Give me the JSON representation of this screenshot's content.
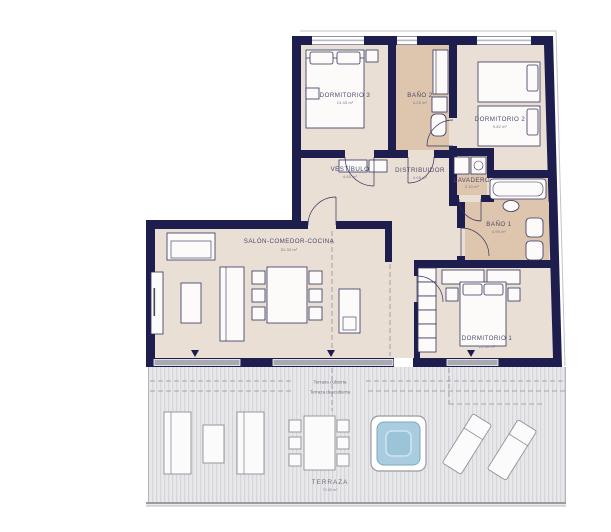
{
  "plan": {
    "title": "apartment-floor-plan",
    "rooms": [
      {
        "id": "dormitorio-3",
        "name": "DORMITORIO 3",
        "area": "13.43 m²"
      },
      {
        "id": "bano-2",
        "name": "BAÑO 2",
        "area": "4.25 m²"
      },
      {
        "id": "dormitorio-2",
        "name": "DORMITORIO 2",
        "area": "9.82 m²"
      },
      {
        "id": "vestibulo",
        "name": "VESTÍBULO",
        "area": "4.65 m²"
      },
      {
        "id": "distribuidor",
        "name": "DISTRIBUIDOR",
        "area": "4.05 m²"
      },
      {
        "id": "lavadero",
        "name": "LAVADERO",
        "area": "2.10 m²"
      },
      {
        "id": "bano-1",
        "name": "BAÑO 1",
        "area": "4.90 m²"
      },
      {
        "id": "salon",
        "name": "SALÓN-COMEDOR-COCINA",
        "area": "51.33 m²"
      },
      {
        "id": "dormitorio-1",
        "name": "DORMITORIO 1",
        "area": "21.60 m²"
      },
      {
        "id": "terraza",
        "name": "TERRAZA",
        "area": "70.86 m²"
      }
    ],
    "terrace_boundaries": {
      "covered": "Terraza cubierta",
      "uncovered": "Terraza descubierta"
    },
    "icons": {
      "terrace_access_marker": "triangle-down",
      "pool": "square-plunge-pool",
      "washer": "washing-machine"
    },
    "colors": {
      "wall": "#1e1e4e",
      "floor": "#eadfd4",
      "wet_floor": "#ddc5ae",
      "terrace": "#e8e8eb",
      "pool_water": "#a9cddf",
      "glass_door": "#a9a9b0",
      "label": "#4b4b6e"
    }
  }
}
